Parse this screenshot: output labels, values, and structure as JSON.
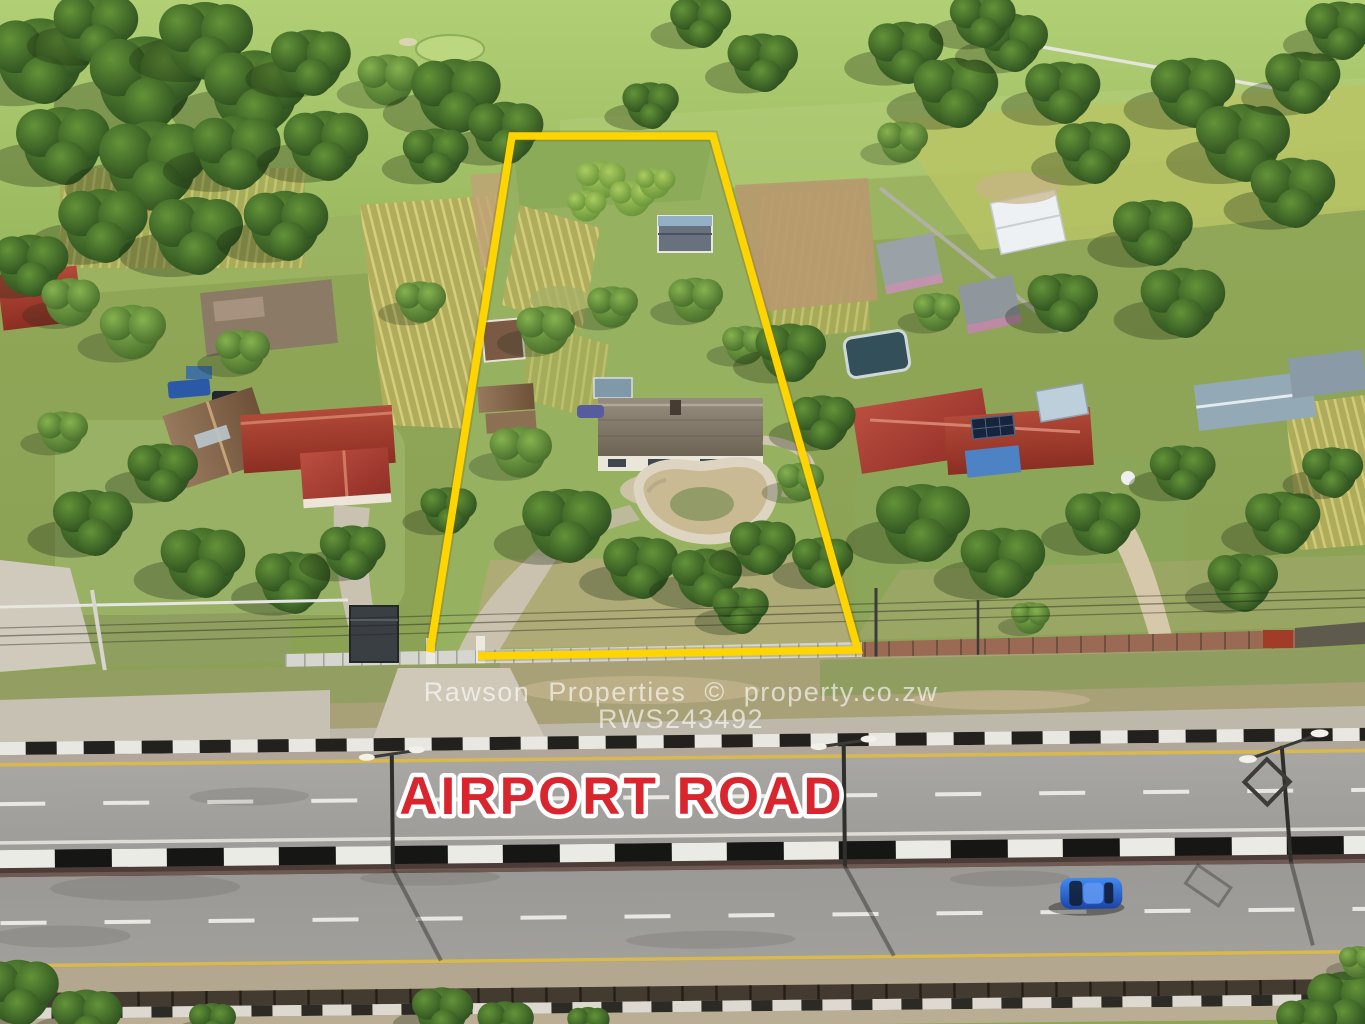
{
  "image": {
    "kind": "aerial-drone-photograph",
    "subject": "Residential plot outlined for sale beside Airport Road",
    "width_px": 1365,
    "height_px": 1024
  },
  "overlays": {
    "road_label": "AIRPORT ROAD",
    "watermark_line1": "Rawson Properties © property.co.zw",
    "watermark_line2": "RWS243492"
  },
  "colors": {
    "boundary_yellow": "#FED500",
    "road_label_red": "#D9262E",
    "road_label_outline": "#FFFFFF",
    "watermark_white": "#FFFFFF",
    "asphalt_gray": "#A3A19C",
    "grass_green": "#93A95C"
  },
  "scene_objects": [
    "yellow-property-boundary",
    "main-house-with-empty-kidney-pool",
    "neighbor-house-red-roof-left",
    "neighbor-house-red-roof-right-solar-panels",
    "golf-course-fairway-top",
    "dual-carriageway-road",
    "black-white-striped-median-barrier",
    "street-light-poles",
    "blue-car-on-road",
    "durawall-fences-along-road"
  ]
}
